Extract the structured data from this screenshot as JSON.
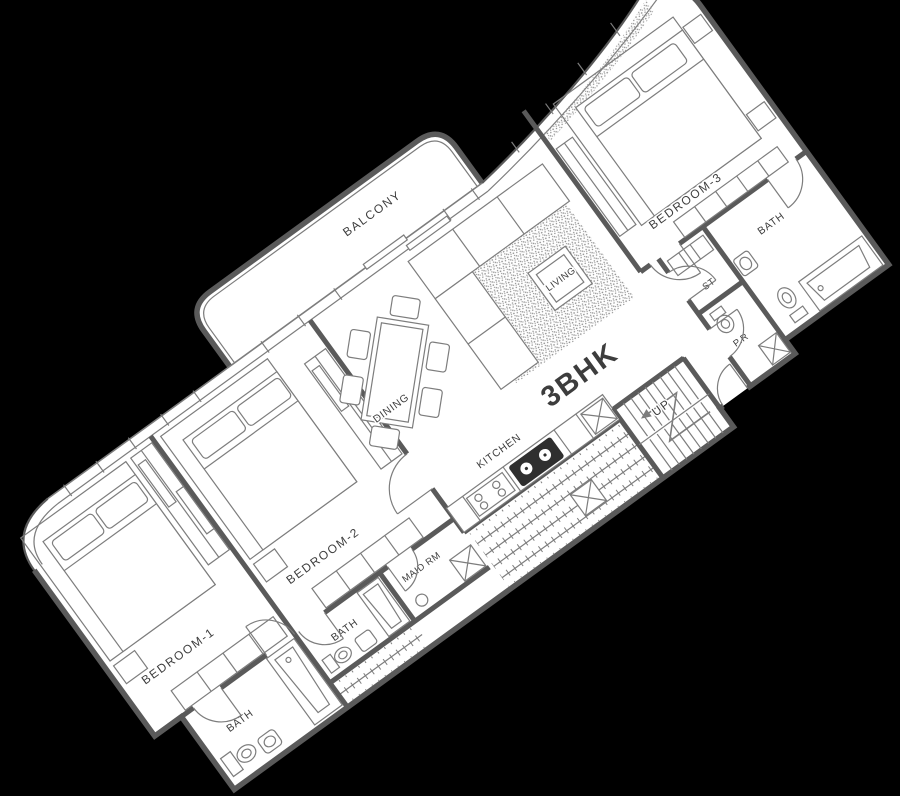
{
  "unit": {
    "type_label": "3BHK"
  },
  "rooms": {
    "balcony": "BALCONY",
    "living": "LIVING",
    "dining": "DINING",
    "kitchen": "KITCHEN",
    "bedroom1": "BEDROOM-1",
    "bedroom2": "BEDROOM-2",
    "bedroom3": "BEDROOM-3",
    "bath1": "BATH",
    "bath2": "BATH",
    "bath3": "BATH",
    "maid_room": "MAID RM",
    "store": "ST",
    "powder_room": "P.R",
    "stairs_up": "UP"
  },
  "colors": {
    "background": "#000000",
    "paper": "#ffffff",
    "wall": "#5a5a5a",
    "line": "#7d7d7d",
    "ink": "#3d3d3d",
    "fixture_dark": "#2f2f2f",
    "speckle": "#8e8e8e"
  }
}
